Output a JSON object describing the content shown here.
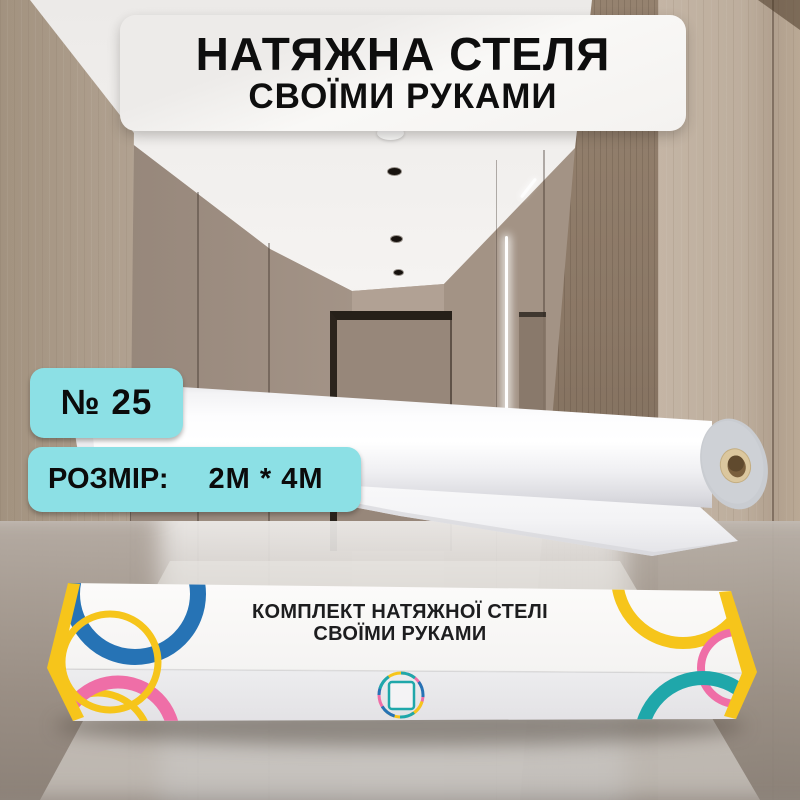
{
  "title_banner": {
    "line1": "НАТЯЖНА СТЕЛЯ",
    "line2": "СВОЇМИ РУКАМИ"
  },
  "labels": {
    "number_badge": "№ 25",
    "size_label": "РОЗМІР:",
    "size_value": "2М * 4М"
  },
  "product_box": {
    "title_line1": "КОМПЛЕКТ НАТЯЖНОЇ СТЕЛІ",
    "title_line2": "СВОЇМИ РУКАМИ"
  },
  "colors": {
    "badge_bg": "#8CE0E5",
    "accent_yellow": "#F6C51B",
    "accent_blue": "#2673B5",
    "accent_pink": "#EF6EA7",
    "accent_teal": "#1FA7AA",
    "banner_bg": "#F7F5F3",
    "text_dark": "#111111"
  }
}
